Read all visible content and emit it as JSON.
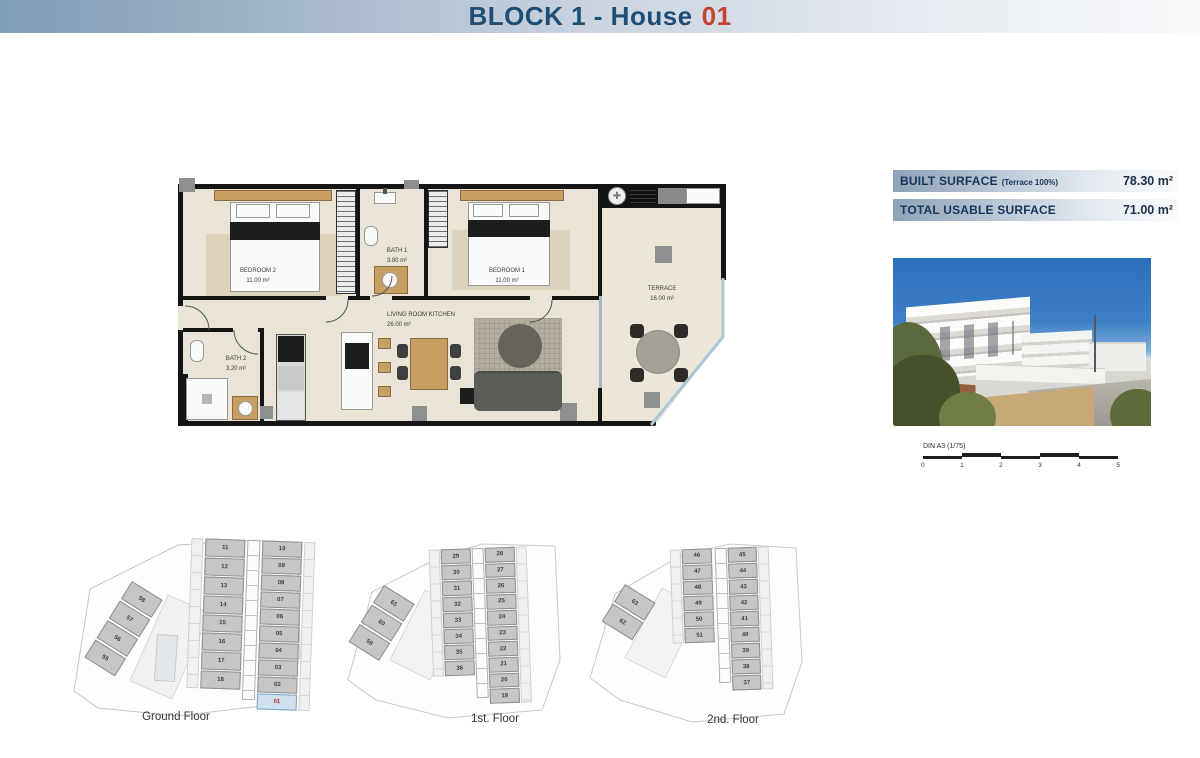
{
  "header": {
    "title": "BLOCK 1 - House",
    "number": "01"
  },
  "colors": {
    "navy": "#1d4e75",
    "red": "#c64433",
    "unit_highlight": "#cfe0ee"
  },
  "surface_table": {
    "rows": [
      {
        "label": "BUILT SURFACE",
        "note": "(Terrace 100%)",
        "value": "78.30 m²"
      },
      {
        "label": "TOTAL USABLE SURFACE",
        "note": "",
        "value": "71.00 m²"
      }
    ]
  },
  "plan": {
    "rooms": [
      {
        "name": "BEDROOM 2",
        "area": "11.00 m²"
      },
      {
        "name": "BATH 1",
        "area": "3.80 m²"
      },
      {
        "name": "BEDROOM 1",
        "area": "11.00 m²"
      },
      {
        "name": "TERRACE",
        "area": "16.00 m²"
      },
      {
        "name": "LIVING ROOM KITCHEN",
        "area": "26.00 m²"
      },
      {
        "name": "BATH 2",
        "area": "3.20 m²"
      }
    ]
  },
  "scale_bar": {
    "label": "DIN A3 (1/75)",
    "ticks": [
      "0",
      "1",
      "2",
      "3",
      "4",
      "5"
    ]
  },
  "floor_keys": [
    {
      "label": "Ground Floor",
      "left_units": [
        {
          "n": "11"
        },
        {
          "n": "12"
        },
        {
          "n": "13"
        },
        {
          "n": "14"
        },
        {
          "n": "15"
        },
        {
          "n": "16"
        },
        {
          "n": "17"
        },
        {
          "n": "18"
        }
      ],
      "right_units": [
        {
          "n": "10"
        },
        {
          "n": "09"
        },
        {
          "n": "08"
        },
        {
          "n": "07"
        },
        {
          "n": "06"
        },
        {
          "n": "05"
        },
        {
          "n": "04"
        },
        {
          "n": "03"
        },
        {
          "n": "02"
        },
        {
          "n": "01",
          "hl": true
        }
      ],
      "wing_units": [
        {
          "n": "58"
        },
        {
          "n": "57"
        },
        {
          "n": "56"
        },
        {
          "n": "55"
        }
      ]
    },
    {
      "label": "1st. Floor",
      "left_units": [
        {
          "n": "29"
        },
        {
          "n": "30"
        },
        {
          "n": "31"
        },
        {
          "n": "32"
        },
        {
          "n": "33"
        },
        {
          "n": "34"
        },
        {
          "n": "35"
        },
        {
          "n": "36"
        }
      ],
      "right_units": [
        {
          "n": "28"
        },
        {
          "n": "27"
        },
        {
          "n": "26"
        },
        {
          "n": "25"
        },
        {
          "n": "24"
        },
        {
          "n": "23"
        },
        {
          "n": "22"
        },
        {
          "n": "21"
        },
        {
          "n": "20"
        },
        {
          "n": "19"
        }
      ],
      "wing_units": [
        {
          "n": "61"
        },
        {
          "n": "60"
        },
        {
          "n": "59"
        }
      ]
    },
    {
      "label": "2nd. Floor",
      "left_units": [
        {
          "n": "46"
        },
        {
          "n": "47"
        },
        {
          "n": "48"
        },
        {
          "n": "49"
        },
        {
          "n": "50"
        },
        {
          "n": "51"
        }
      ],
      "right_units": [
        {
          "n": "45"
        },
        {
          "n": "44"
        },
        {
          "n": "43"
        },
        {
          "n": "42"
        },
        {
          "n": "41"
        },
        {
          "n": "40"
        },
        {
          "n": "39"
        },
        {
          "n": "38"
        },
        {
          "n": "37"
        }
      ],
      "wing_units": [
        {
          "n": "63"
        },
        {
          "n": "62"
        }
      ]
    }
  ]
}
